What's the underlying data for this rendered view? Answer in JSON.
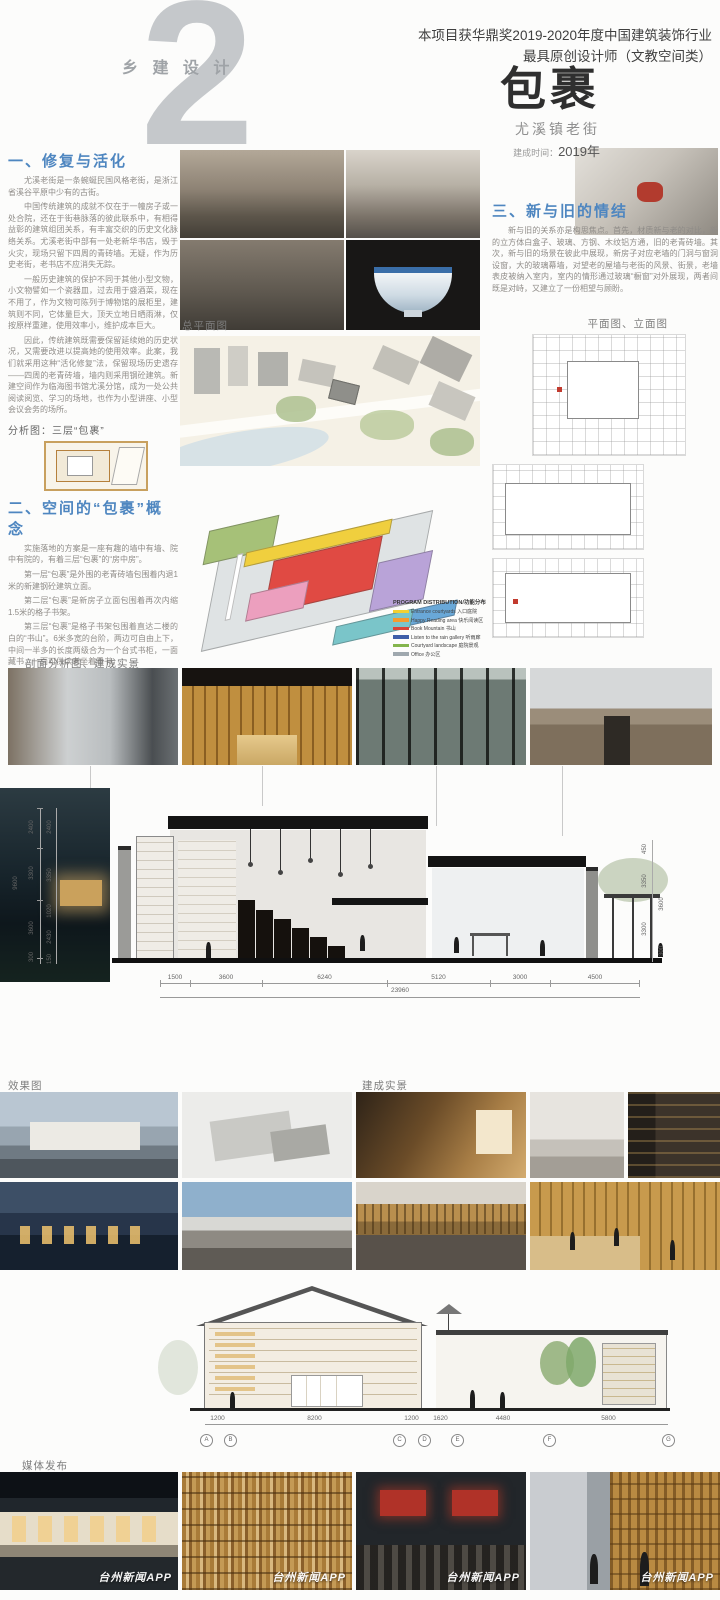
{
  "header": {
    "chapter": "乡 建 设 计",
    "number": "2",
    "award1": "本项目获华鼎奖2019-2020年度中国建筑装饰行业",
    "award2": "最具原创设计师（文教空间类）",
    "title": "包裹",
    "subtitle": "尤溪镇老街",
    "built_label": "建成时间：",
    "built_year": "2019年"
  },
  "s1": {
    "heading": "一、修复与活化",
    "p1": "尤溪老街是一条蜿蜒民国风格老街，是浙江省溪谷平原中少有的古街。",
    "p2": "中国传统建筑的成就不仅在于一幢房子或一处合院，还在于街巷脉落的彼此联系中，有相得益彰的建筑组团关系，有丰富交织的历史文化脉络关系。尤溪老街中部有一处老新华书店，毁于火灾，现场只留下四周的青砖墙。无疑，作为历史老街，老书店不应消失无踪。",
    "p3": "一般历史建筑的保护不同于其他小型文物，小文物譬如一个瓷器皿，过去用于盛酒菜，现在不用了，作为文物可陈列于博物馆的展柜里，建筑则不同，它体量巨大，顶天立地日晒雨淋，仅按原样重建，使用效率小，维护成本巨大。",
    "p4": "因此，传统建筑既需要保留延续她的历史状况，又需要改进以提高她的使用效率。此案，我们就采用这种“活化修复”法，保留现场历史遗存——四周的老青砖墙，墙内则采用钢砼建筑。新建空间作为临海图书馆尤溪分馆，成为一处公共阅读阅览、学习的场地，也作为小型讲座、小型会议会务的场所。"
  },
  "s2": {
    "heading": "二、空间的“包裹”概念",
    "p1": "实施落地的方案是一座有趣的墙中有墙、院中有院的，有着三层“包裹”的“房中房”。",
    "p2": "第一层“包裹”是外围的老青砖墙包围着内退1米的新建钢砼建筑立面。",
    "p3": "第二层“包裹”是新房子立面包围着再次内缩1.5米的格子书架。",
    "p4": "第三层“包裹”是格子书架包围着直达二楼的白的“书山”。6米多宽的台阶，两边可自由上下，中间一半多的长度两级合为一个台式书柜，一面藏书，一面可供读者坐着看书。",
    "p5": "三层包裹带出了空场与通道，形成了空间的宽阔与紧窄，似乡间巷陌串联院落，塑造了场所的跃动与静谧，明亮与阴翳，直白与含蓄。"
  },
  "s3": {
    "heading": "三、新与旧的情结",
    "p1": "新与旧的关系亦是构思焦点。首先，材质新与老的对比，新的立方体白盒子、玻璃、方钢、木纹铝方通，旧的老青砖墙。其次，新与旧的场景在彼此中展现，新房子对应老墙的门洞与窗洞设窗，大的玻璃幕墙，对望老的屋墙与老街的风景、街景，老墙表皮被纳入室内，室内的情形通过玻璃“橱窗”对外展现，两者间既是对峙，又建立了一份相望与顾盼。"
  },
  "labels": {
    "analysis": "分析图：三层“包裹”",
    "site_plan": "总平面图",
    "plan_elevation": "平面图、立面图",
    "section_analysis": "剖面分析图、建成实景",
    "renders": "效果图",
    "built": "建成实景",
    "media": "媒体发布"
  },
  "legend": {
    "title": "PROGRAM DISTRIBUTION/功能分布",
    "items": [
      {
        "label": "Entrance courtyards 入口庭院",
        "color": "#f3d02f"
      },
      {
        "label": "Happy Reading area 快乐阅读区",
        "color": "#f59b2d"
      },
      {
        "label": "Book Mountain 书山",
        "color": "#d94436"
      },
      {
        "label": "Listen to the rain gallery 听雨廊",
        "color": "#3f5ea9"
      },
      {
        "label": "Courtyard landscape 庭院景观",
        "color": "#84b54d"
      },
      {
        "label": "Office 办公区",
        "color": "#9fa8ae"
      }
    ]
  },
  "big_section": {
    "bottom_dims": [
      "1500",
      "3600",
      "6240",
      "5120",
      "3000",
      "4500"
    ],
    "total": "23960",
    "left_total": "9600",
    "left_dims": [
      "2400",
      "3300",
      "3600",
      "300"
    ],
    "left_inner": [
      "2400",
      "3350",
      "1020",
      "2430",
      "150"
    ],
    "right_dims": [
      "450",
      "3350",
      "3300",
      "3600",
      "300"
    ]
  },
  "lower_section": {
    "dims": [
      "1200",
      "8200",
      "1200",
      "1620",
      "4480",
      "5800"
    ],
    "bubbles": [
      "A",
      "B",
      "C",
      "D",
      "E",
      "F",
      "G"
    ]
  },
  "media": {
    "watermark": "台州新闻APP"
  },
  "colors": {
    "heading_blue": "#4e86c0",
    "number_gray": "#c5c8cb",
    "title_dark": "#2f2f2f"
  }
}
